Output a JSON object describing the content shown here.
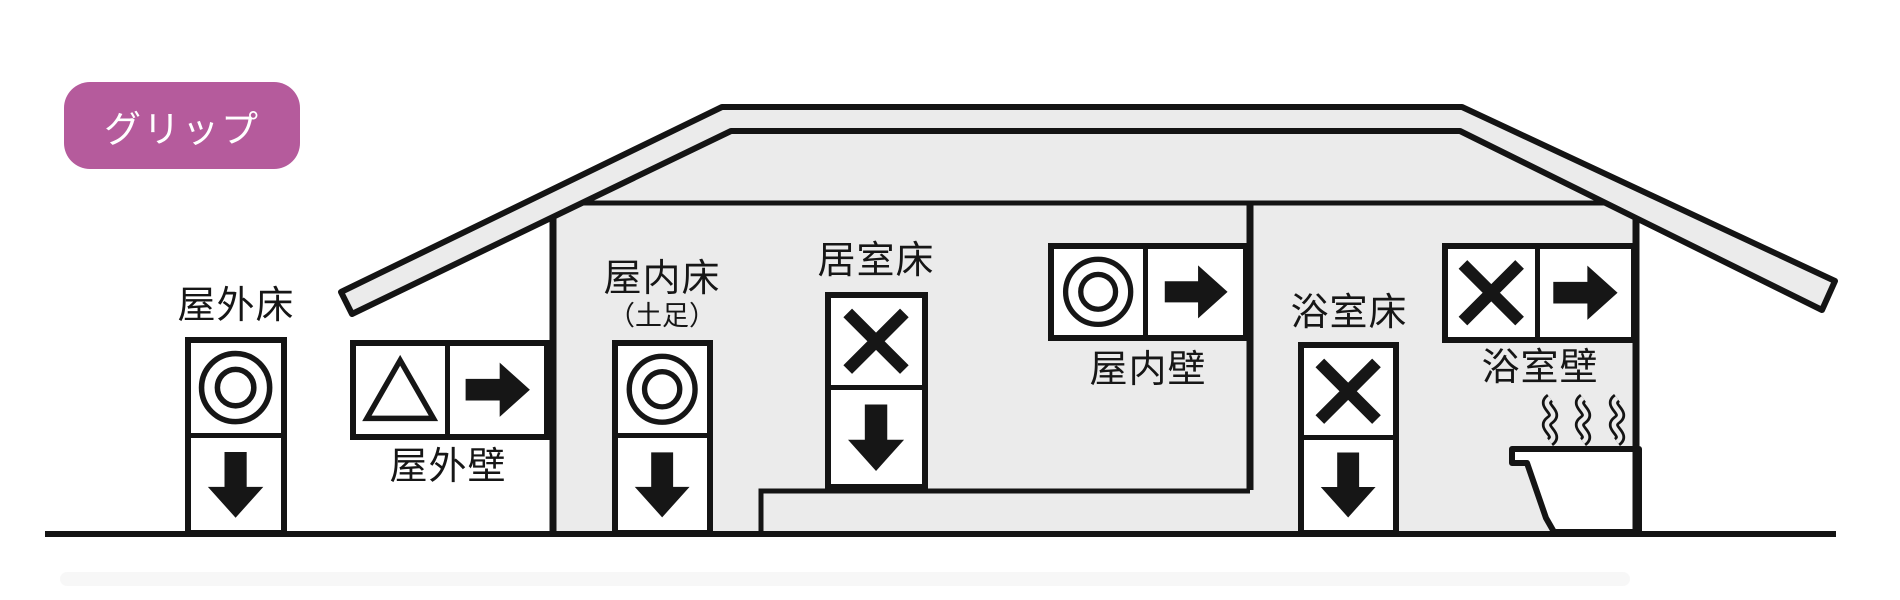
{
  "badge": {
    "label": "グリップ",
    "bg_color": "#b55b9c",
    "text_color": "#ffffff"
  },
  "signs": [
    {
      "id": "outdoor-floor",
      "label": "屋外床",
      "sublabel": "",
      "layout": "vertical",
      "symbols": [
        "double-circle",
        "down-arrow"
      ]
    },
    {
      "id": "outdoor-wall",
      "label": "屋外壁",
      "sublabel": "",
      "layout": "horizontal",
      "symbols": [
        "triangle",
        "right-arrow"
      ]
    },
    {
      "id": "indoor-floor-shoes",
      "label": "屋内床",
      "sublabel": "（土足）",
      "layout": "vertical",
      "symbols": [
        "double-circle",
        "down-arrow"
      ]
    },
    {
      "id": "living-room-floor",
      "label": "居室床",
      "sublabel": "",
      "layout": "vertical",
      "symbols": [
        "cross",
        "down-arrow"
      ]
    },
    {
      "id": "indoor-wall",
      "label": "屋内壁",
      "sublabel": "",
      "layout": "horizontal",
      "symbols": [
        "double-circle",
        "right-arrow"
      ]
    },
    {
      "id": "bathroom-floor",
      "label": "浴室床",
      "sublabel": "",
      "layout": "vertical",
      "symbols": [
        "cross",
        "down-arrow"
      ]
    },
    {
      "id": "bathroom-wall",
      "label": "浴室壁",
      "sublabel": "",
      "layout": "horizontal",
      "symbols": [
        "cross",
        "right-arrow"
      ]
    }
  ],
  "house": {
    "fill_color": "#ebebeb",
    "line_color": "#141414",
    "icons": [
      "roof",
      "ground-line",
      "bathtub-icon",
      "steam-icon"
    ]
  }
}
